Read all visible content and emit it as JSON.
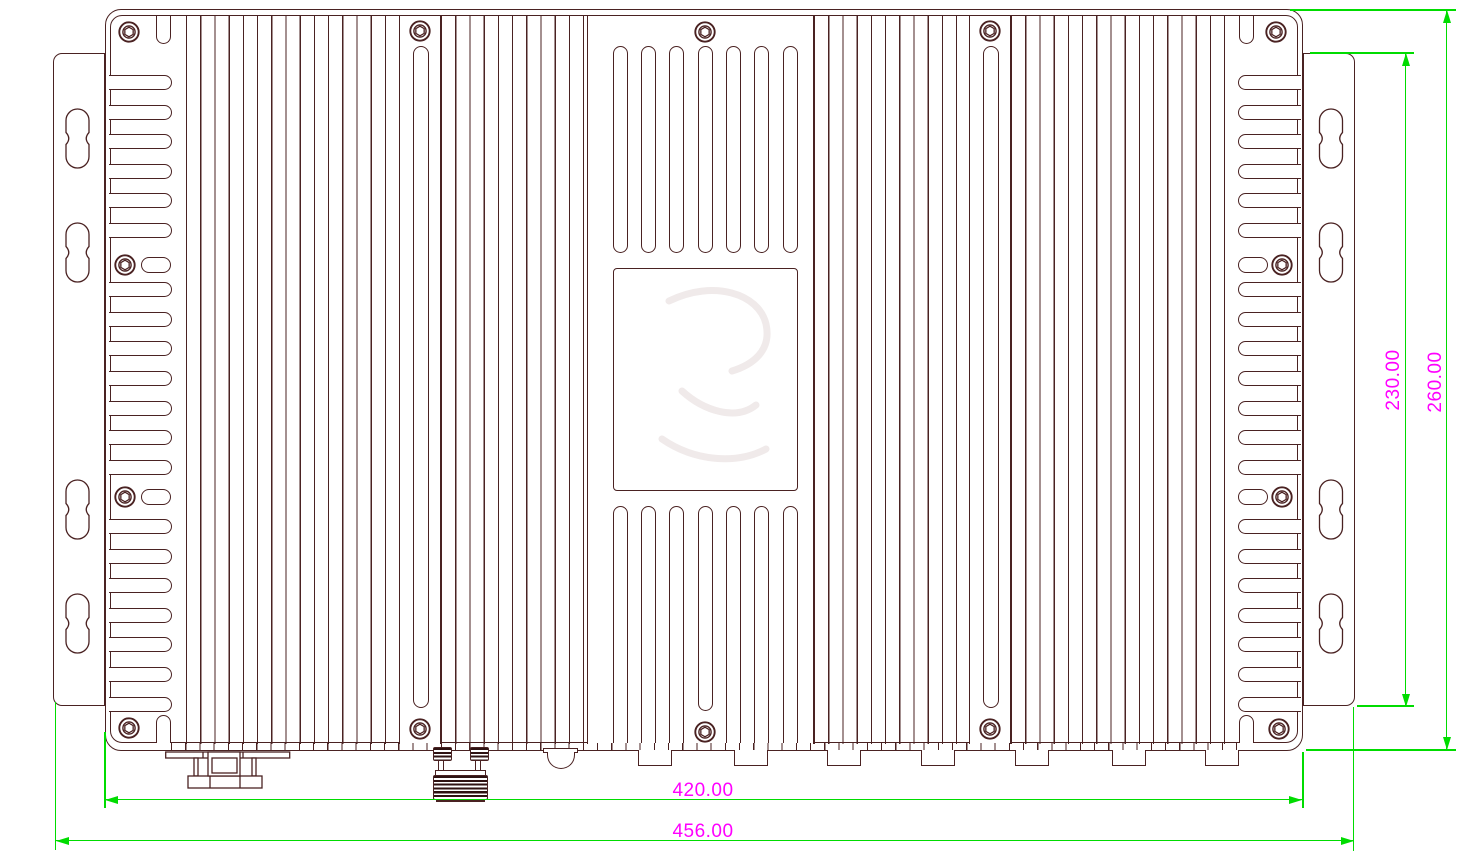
{
  "dims": {
    "body_width": "420.00",
    "overall_width": "456.00",
    "bracket_height": "230.00",
    "overall_height": "260.00"
  },
  "colors": {
    "outline": "#4a2222",
    "dimension_line": "#00dc00",
    "dimension_text": "#ff00ff"
  }
}
